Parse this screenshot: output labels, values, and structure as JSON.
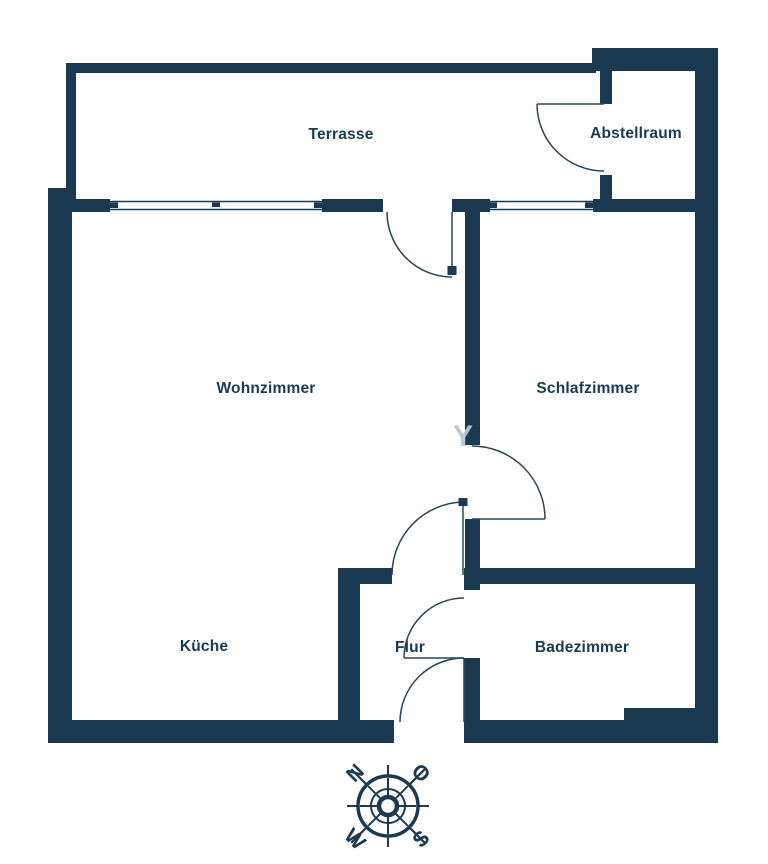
{
  "floorplan": {
    "rooms": {
      "terrasse": {
        "label": "Terrasse"
      },
      "abstellraum": {
        "label": "Abstellraum"
      },
      "wohnzimmer": {
        "label": "Wohnzimmer"
      },
      "schlafzimmer": {
        "label": "Schlafzimmer"
      },
      "kueche": {
        "label": "Küche"
      },
      "flur": {
        "label": "Flur"
      },
      "badezimmer": {
        "label": "Badezimmer"
      }
    },
    "watermark": "Y",
    "compass": {
      "n": "N",
      "o": "O",
      "s": "S",
      "w": "W"
    },
    "colors": {
      "wall": "#1b3a52",
      "background": "#ffffff",
      "door_line": "#2a4559",
      "watermark": "#b9c6cf"
    }
  }
}
